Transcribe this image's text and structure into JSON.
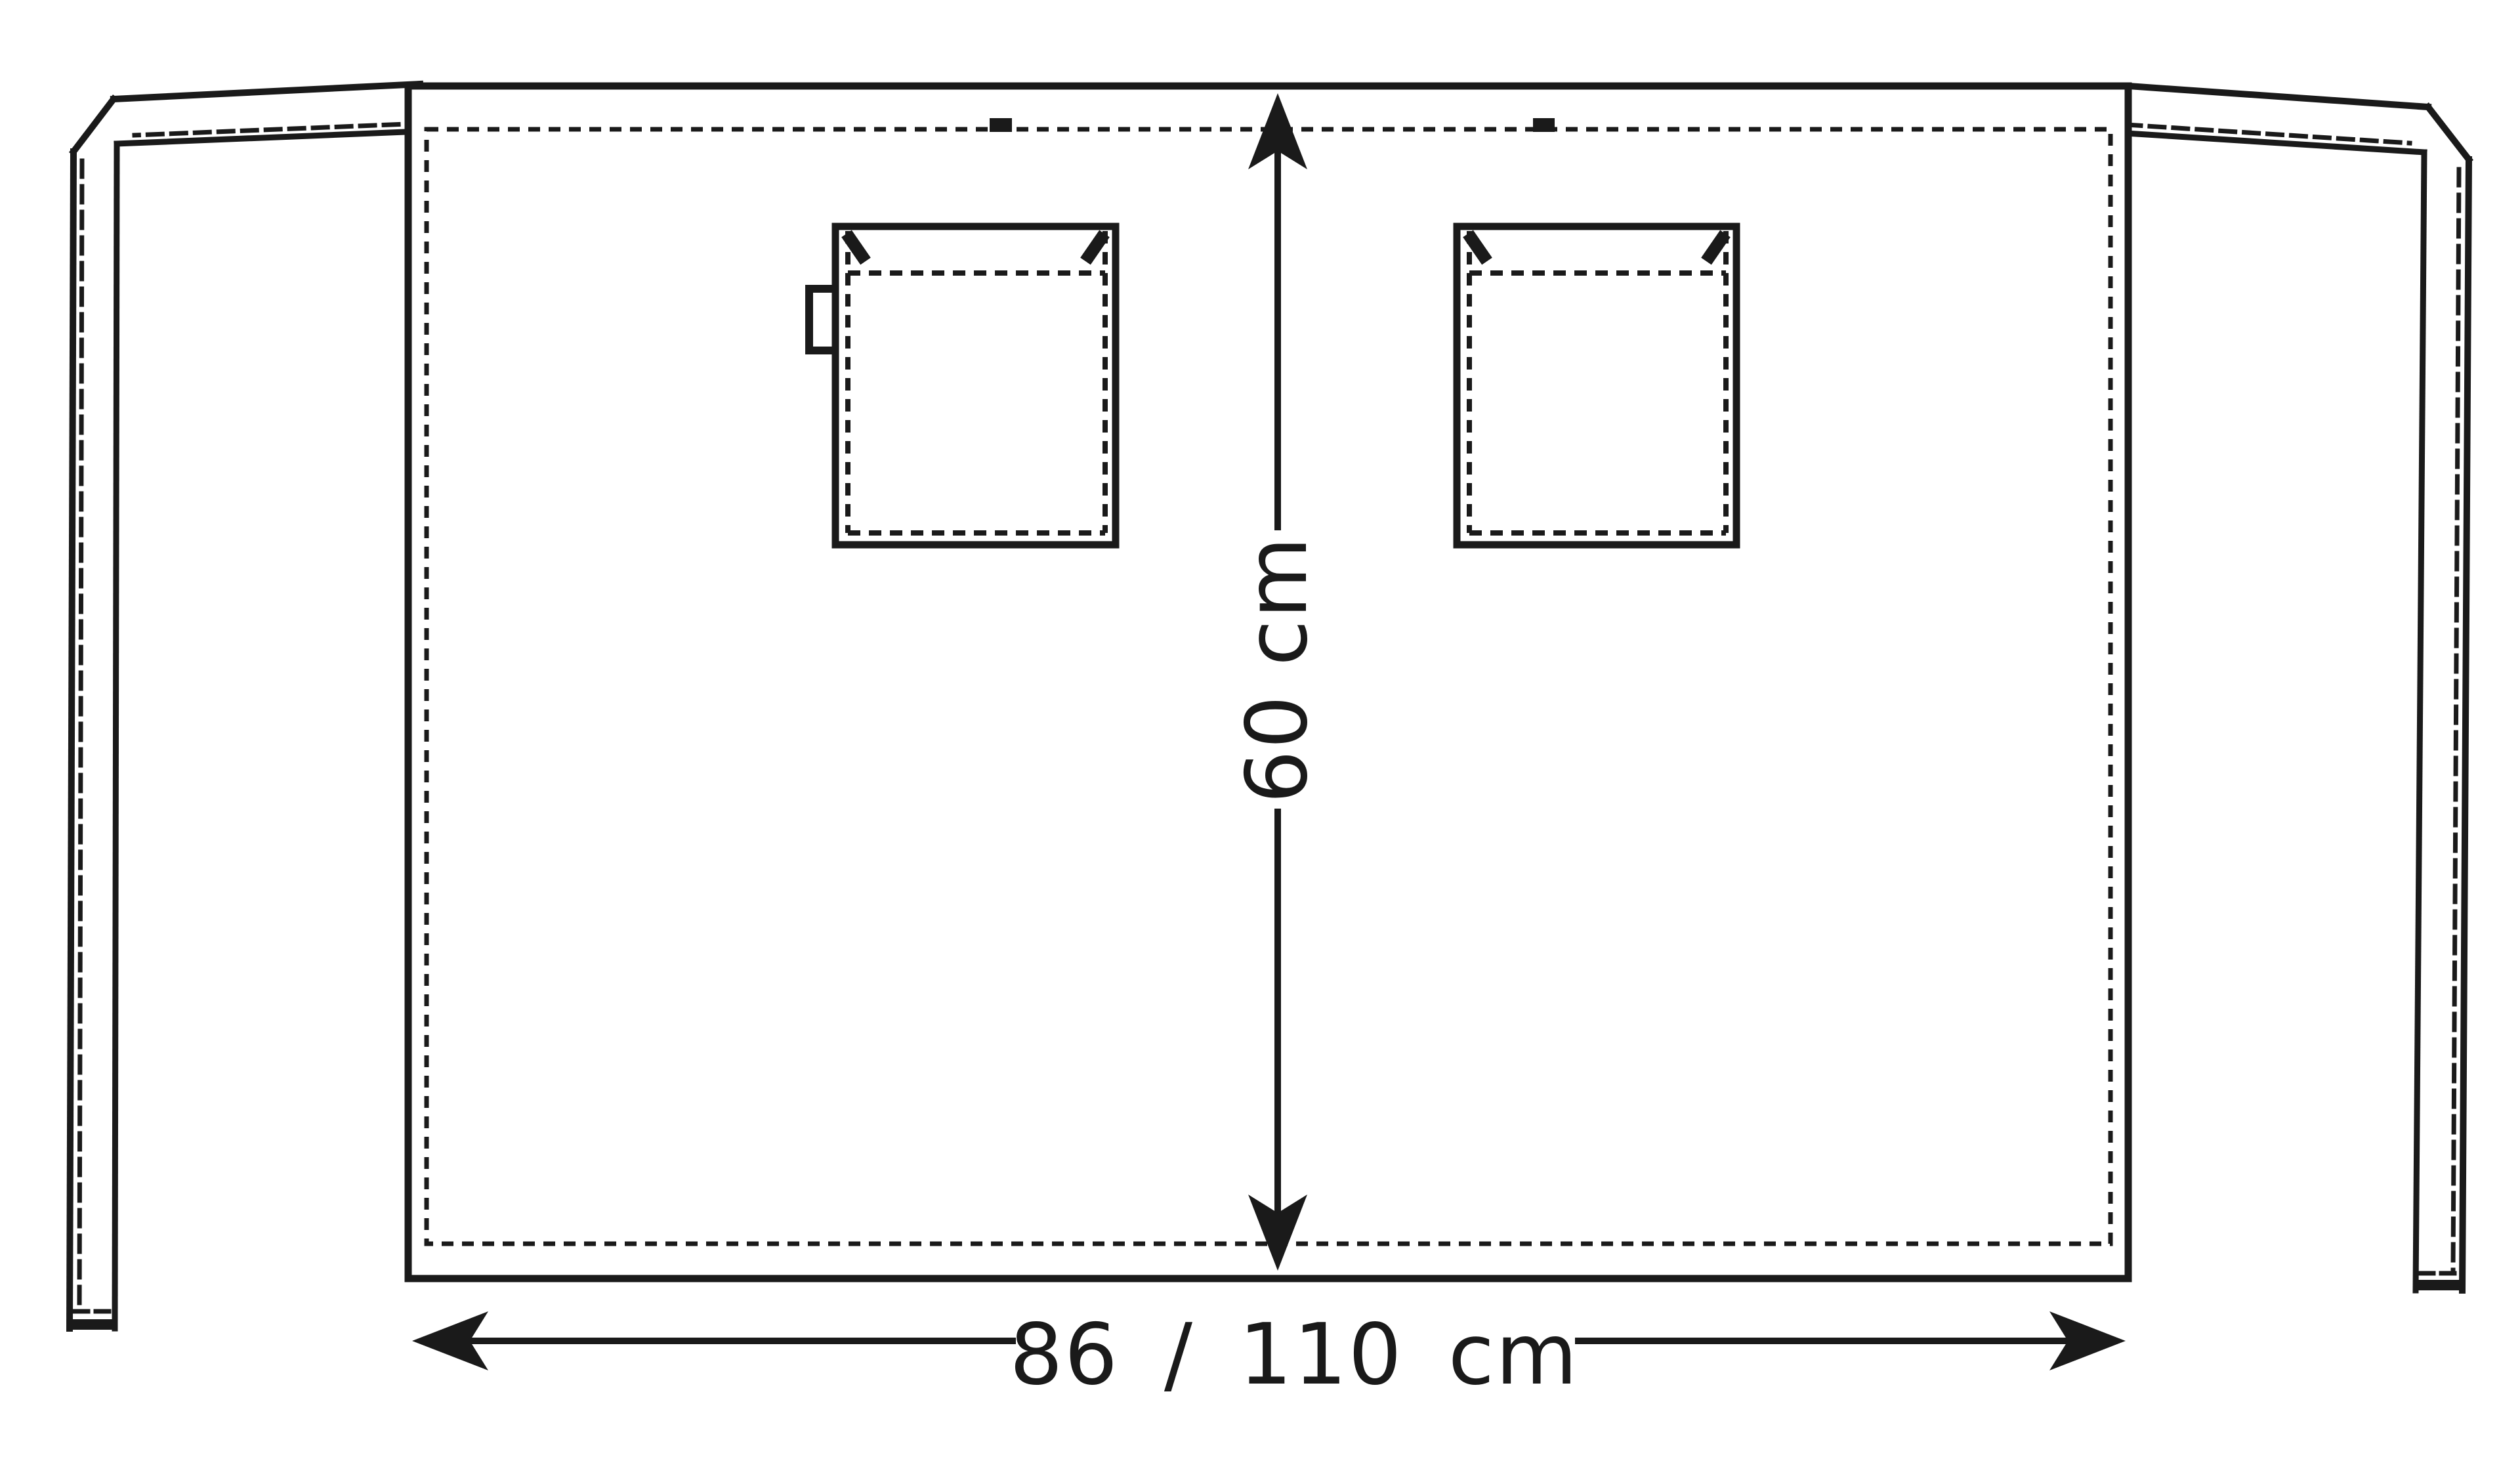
{
  "diagram": {
    "kind": "apron-technical-drawing",
    "height_label": "60 cm",
    "width_label": "86 / 110 cm",
    "colors": {
      "line": "#1a1a1a",
      "background": "#ffffff"
    },
    "parts": {
      "body": "apron body panel",
      "left_tie": "left waist tie strap",
      "right_tie": "right waist tie strap",
      "left_pocket": "left patch pocket",
      "right_pocket": "right patch pocket",
      "pocket_tab": "pen/towel loop tab",
      "loop_marks": "hanging loop marks on waist seam",
      "height_dimension": "vertical dimension arrow",
      "width_dimension": "horizontal dimension arrow"
    }
  }
}
